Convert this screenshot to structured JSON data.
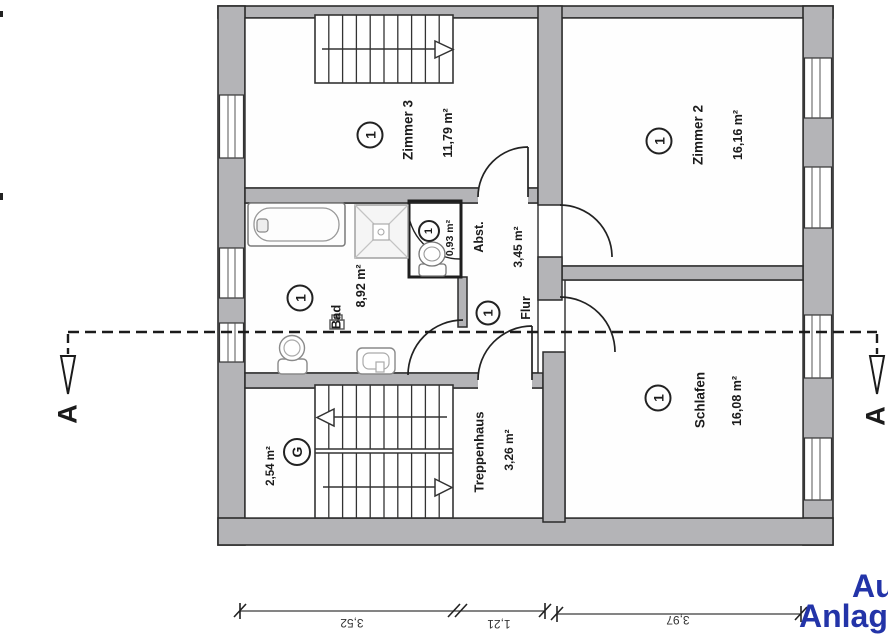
{
  "plan": {
    "rooms": {
      "zimmer3": {
        "badge": "1",
        "name": "Zimmer 3",
        "area": "11,79 m²"
      },
      "zimmer2": {
        "badge": "1",
        "name": "Zimmer 2",
        "area": "16,16 m²"
      },
      "bad": {
        "badge": "1",
        "name": "Bad",
        "area": "8,92 m²"
      },
      "wc": {
        "badge": "1",
        "area": "0,93 m²"
      },
      "abstellraum": {
        "name": "Abst.",
        "area": "3,45 m²"
      },
      "flur": {
        "badge": "1",
        "name": "Flur"
      },
      "schlafen": {
        "badge": "1",
        "name": "Schlafen",
        "area": "16,08 m²"
      },
      "treppenhaus": {
        "name": "Treppenhaus",
        "area": "3,26 m²"
      },
      "g_raum": {
        "badge": "G",
        "area": "2,54 m²"
      }
    },
    "section_marker": {
      "left_label": "A",
      "right_label": "A"
    },
    "dimensions_bottom": {
      "segments": [
        "3,52",
        "1,21",
        "3,97"
      ]
    },
    "corner_text": {
      "line1": "Au",
      "line2": "Anlag",
      "color": "#2334a8"
    },
    "colors": {
      "wall_fill": "#b4b4b7",
      "wall_stroke": "#2b2b2b"
    }
  }
}
